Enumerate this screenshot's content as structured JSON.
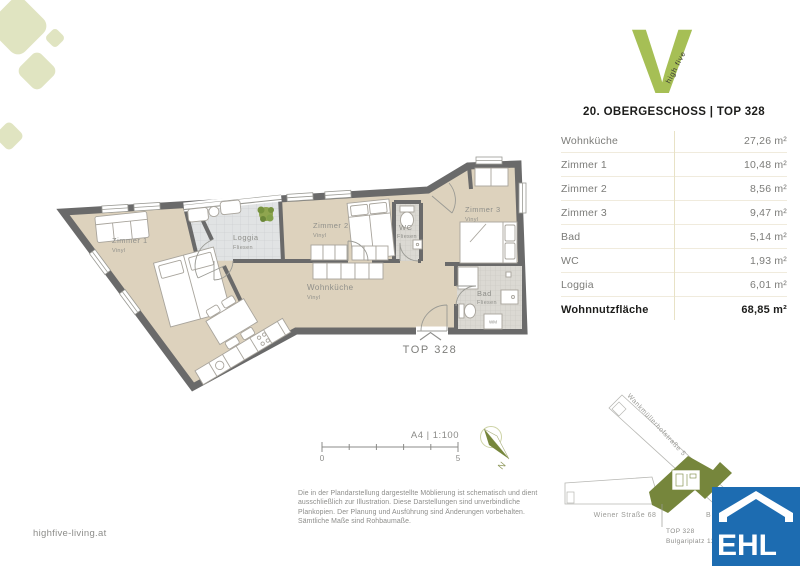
{
  "logo": {
    "letter": "V",
    "tagline": "high five"
  },
  "header": {
    "title": "20. OBERGESCHOSS | TOP 328"
  },
  "area_table": {
    "rows": [
      {
        "label": "Wohnküche",
        "value": "27,26 m²"
      },
      {
        "label": "Zimmer 1",
        "value": "10,48 m²"
      },
      {
        "label": "Zimmer 2",
        "value": "8,56 m²"
      },
      {
        "label": "Zimmer 3",
        "value": "9,47 m²"
      },
      {
        "label": "Bad",
        "value": "5,14 m²"
      },
      {
        "label": "WC",
        "value": "1,93 m²"
      },
      {
        "label": "Loggia",
        "value": "6,01 m²"
      }
    ],
    "total_label": "Wohnnutzfläche",
    "total_value": "68,85 m²"
  },
  "floorplan": {
    "unit_label": "TOP 328",
    "rooms": {
      "zimmer1": {
        "name": "Zimmer 1",
        "floor": "Vinyl"
      },
      "loggia": {
        "name": "Loggia",
        "floor": "Fliesen"
      },
      "zimmer2": {
        "name": "Zimmer 2",
        "floor": "Vinyl"
      },
      "wc": {
        "name": "WC",
        "floor": "Fliesen"
      },
      "zimmer3": {
        "name": "Zimmer 3",
        "floor": "Vinyl"
      },
      "wohnkueche": {
        "name": "Wohnküche",
        "floor": "Vinyl"
      },
      "bad": {
        "name": "Bad",
        "floor": "Fliesen"
      }
    },
    "washing_machine_label": "WM"
  },
  "scale_bar": {
    "label": "A4 | 1:100",
    "start": "0",
    "end": "5"
  },
  "compass": {
    "north_label": "N"
  },
  "disclaimer": {
    "line1": "Die in der Plandarstellung dargestellte Möblierung ist schematisch und dient",
    "line2": "ausschließlich zur Illustration. Diese Darstellungen sind unverbindliche",
    "line3": "Plankopien. Der Planung und Ausführung sind Änderungen vorbehalten.",
    "line4": "Sämtliche Maße sind Rohbaumaße."
  },
  "site_map": {
    "street_diagonal": "Wankmüllerhofstraße 5",
    "street_horizontal": "Wiener Straße 68",
    "hidden_street_fragment": "B",
    "callout_line1": "TOP 328",
    "callout_line2": "Bulgariplatz 11"
  },
  "footer": {
    "website": "highfive-living.at"
  },
  "agency_logo": {
    "text": "EHL"
  },
  "colors": {
    "brand_green": "#a6bf55",
    "pale_green": "#e0e4c1",
    "olive_building": "#76863c",
    "ehl_blue": "#1d6cb1",
    "floor_beige": "#ddd2bd",
    "wall_gray": "#6a6a6a"
  }
}
